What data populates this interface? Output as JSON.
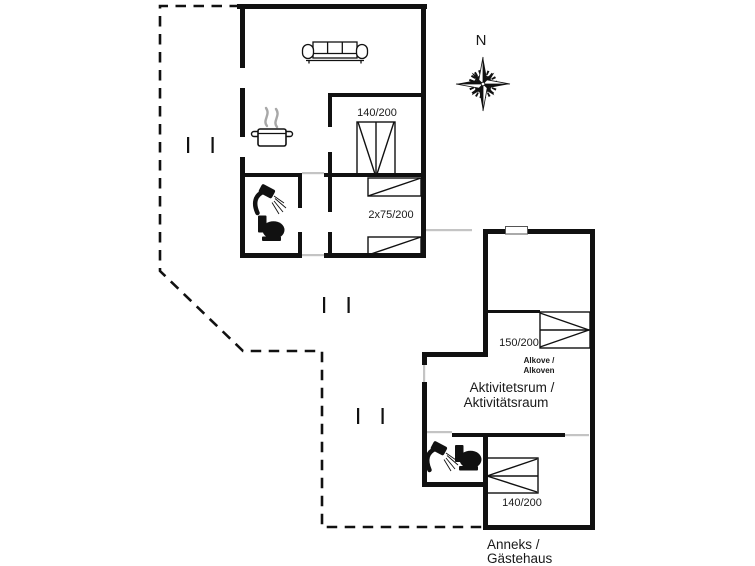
{
  "compass": {
    "label": "N"
  },
  "main_house": {
    "bedroom1_bed_label": "140/200",
    "bedroom2_bed_label": "2x75/200"
  },
  "annex": {
    "alkove_bed_label": "150/200",
    "alkove_label_line1": "Alkove /",
    "alkove_label_line2": "Alkoven",
    "activity_room_line1": "Aktivitetsrum /",
    "activity_room_line2": "Aktivitätsraum",
    "bedroom_bed_label": "140/200",
    "caption_line1": "Anneks /",
    "caption_line2": "Gästehaus"
  },
  "colors": {
    "wall": "#111111",
    "threshold": "#c4c4c4",
    "steam": "#a8a8a8",
    "background": "#ffffff"
  }
}
